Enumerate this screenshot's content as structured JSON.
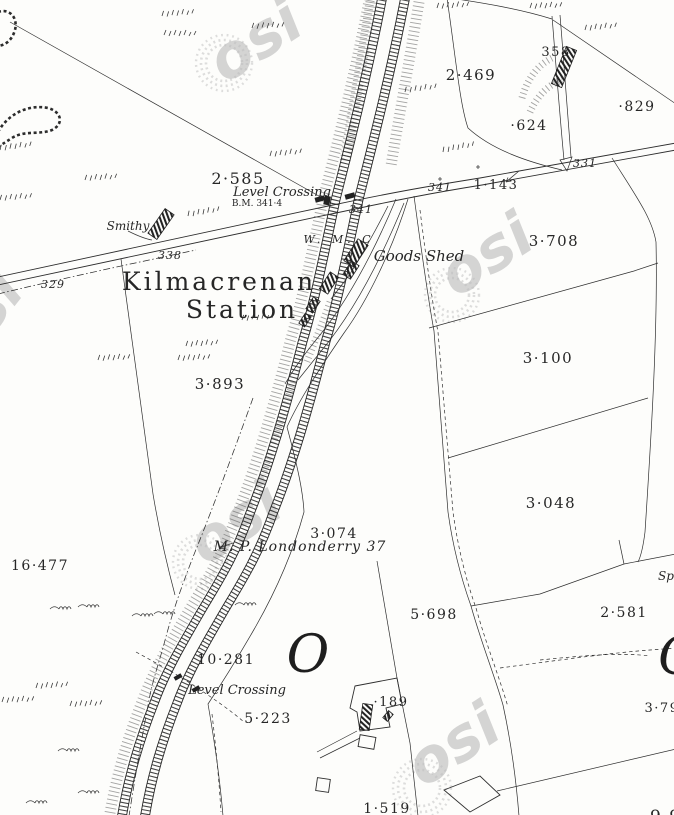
{
  "map": {
    "colors": {
      "ink": "#2a2a2a",
      "watermark": "#bcbcbc",
      "paper": "#fdfdfb"
    },
    "watermark": {
      "text": "osi"
    },
    "station": {
      "line1": "Kilmacrenan",
      "line2": "Station"
    },
    "features": {
      "goods_shed": "Goods Shed",
      "smithy": "Smithy",
      "weighing_machine": "W. M. C",
      "level_crossing_north": "Level Crossing",
      "bench_mark": "B.M. 341·4",
      "level_crossing_south": "Level Crossing",
      "milepost": "M. P. Londonderry 37",
      "spring_partial": "Sp",
      "script_letter_o": "O",
      "script_letter_c": "C",
      "corner_numerals": "9 9"
    },
    "parcel_areas": [
      {
        "value": "2·585"
      },
      {
        "value": "2·469"
      },
      {
        "value": "·829"
      },
      {
        "value": "·624"
      },
      {
        "value": "358"
      },
      {
        "value": "3·708"
      },
      {
        "value": "3·100"
      },
      {
        "value": "3·048"
      },
      {
        "value": "3·893"
      },
      {
        "value": "3·074"
      },
      {
        "value": "1·143"
      },
      {
        "value": "16·477"
      },
      {
        "value": "10·281"
      },
      {
        "value": "5·223"
      },
      {
        "value": "5·698"
      },
      {
        "value": "2·581"
      },
      {
        "value": "·189"
      },
      {
        "value": "1·519"
      },
      {
        "value": "3·79"
      }
    ],
    "road_levels": [
      {
        "value": "329"
      },
      {
        "value": "338"
      },
      {
        "value": "341"
      },
      {
        "value": "341"
      },
      {
        "value": "331"
      }
    ]
  }
}
